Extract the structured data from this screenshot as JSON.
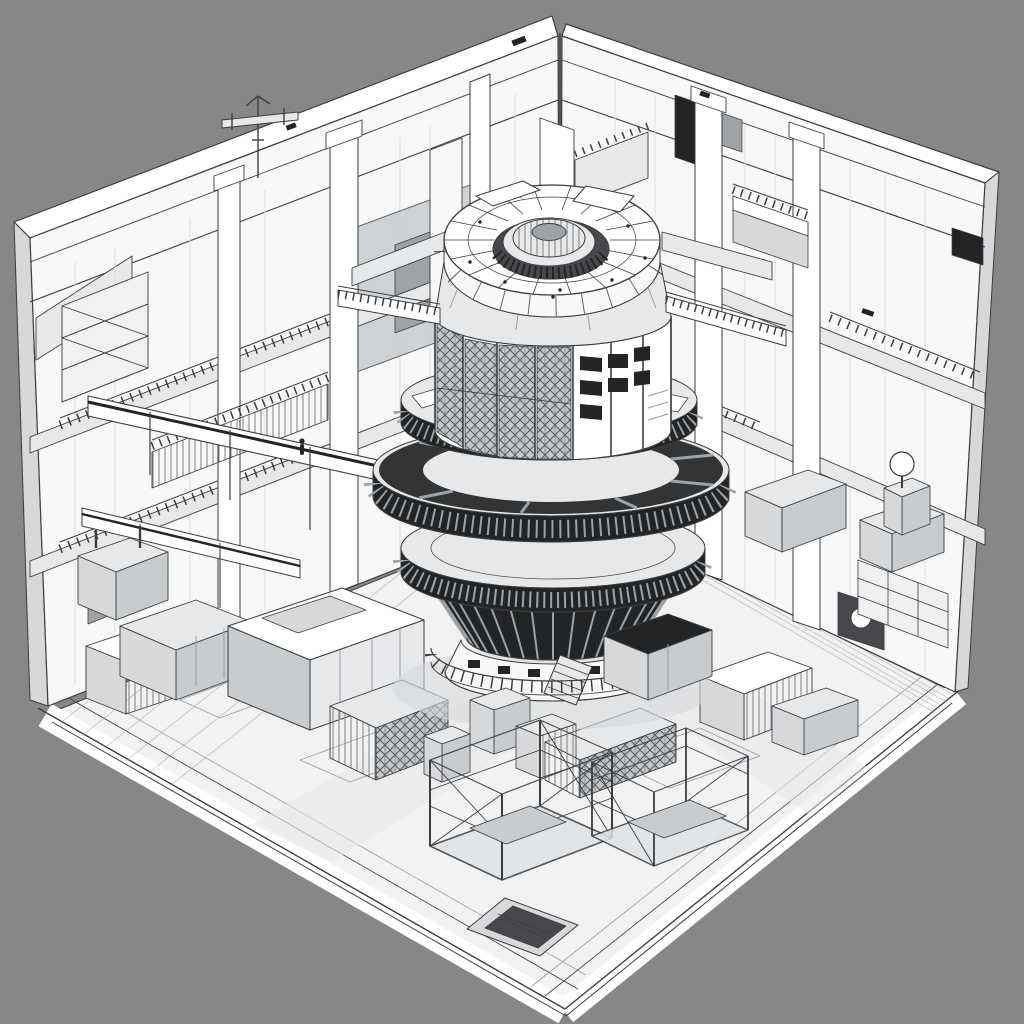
{
  "meta": {
    "title": "Isometric cutaway illustration of an industrial facility",
    "description": "Monochrome technical line-art cutaway of a square facility hall shown in isometric view on a plain gray backdrop. Two interior walls and a floor slab form an open box. In the center stands a large circular multi-tier tower: a white toroidal top ring with a ribbed central hub, a windowed cylindrical drum, three wide ribbed circular decks, a dark finned conical skirt and a fenced round base with a stair. Walkway bridges connect the tower to mezzanines on the walls. The floor is covered with machinery blocks, lattice containers, two open gantry cage frames, a sunken pit, conveyors, racks, balconies and a small antenna mast on the left wall."
  },
  "colors": {
    "bg": "#868789",
    "paper": "#ffffff",
    "floor": "#f2f2f3",
    "wall": "#f8f8f8",
    "shade": "#e7e8ea",
    "edge": "#d6d8da",
    "mid": "#c9ccce",
    "steel": "#9fa3a6",
    "dark": "#232425",
    "well": "#46484b",
    "ink": "#3b3d3f",
    "inklight": "#9b9ea1",
    "glassbg": "#c3c7ca",
    "glassline": "#55585a"
  },
  "scene": {
    "background": "plain gray studio backdrop",
    "style": "black-and-white architectural cutaway line drawing",
    "components": [
      {
        "name": "facility-box",
        "desc": "open isometric room box with white-edged walls and floor slab"
      },
      {
        "name": "central-tower",
        "desc": "multi-tier cylindrical reactor-like tower in hall center"
      },
      {
        "name": "top-ring",
        "desc": "white toroidal ring with radial panels and bolts"
      },
      {
        "name": "hub",
        "desc": "ribbed domed hub inside the ring well"
      },
      {
        "name": "drum",
        "desc": "windowed cylindrical drum with lattice panels"
      },
      {
        "name": "decks",
        "desc": "three ribbed circular decks of increasing width"
      },
      {
        "name": "fin-cone",
        "desc": "dark finned conical skirt"
      },
      {
        "name": "base",
        "desc": "fenced circular base with stair and small windows"
      },
      {
        "name": "bridges",
        "desc": "railed walkway bridges at drum level"
      },
      {
        "name": "conveyors",
        "desc": "long diagonal conveyor beams on the left"
      },
      {
        "name": "cage-frames",
        "desc": "two open gantry cage frames near the front floor edge"
      },
      {
        "name": "pit",
        "desc": "sunken service pit in the front floor"
      },
      {
        "name": "machines",
        "desc": "assorted machine blocks, lattice containers and racks"
      },
      {
        "name": "antenna",
        "desc": "small mast with crossarm on the upper left wall"
      },
      {
        "name": "sphere-lamp",
        "desc": "white sphere lamp on a pedestal at the right wall"
      }
    ]
  }
}
